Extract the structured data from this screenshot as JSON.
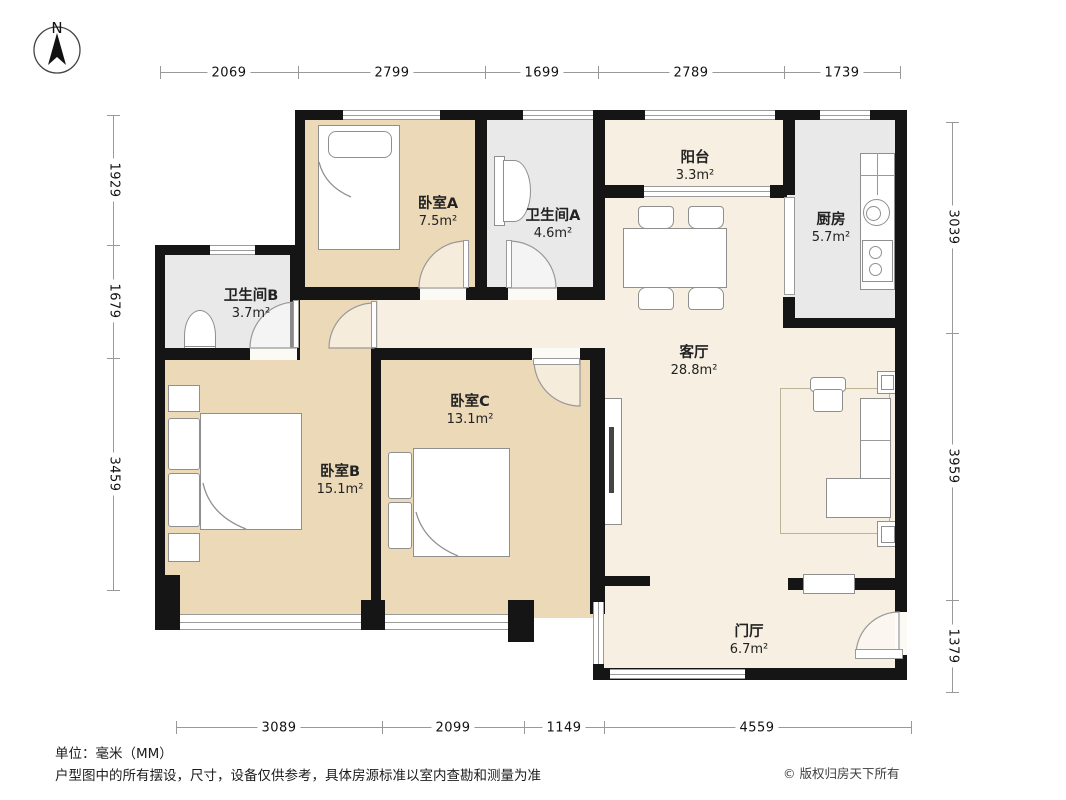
{
  "north": {
    "label": "N"
  },
  "dimensions": {
    "top": [
      "2069",
      "2799",
      "1699",
      "2789",
      "1739"
    ],
    "left": [
      "1929",
      "1679",
      "3459"
    ],
    "right": [
      "3039",
      "3959",
      "1379"
    ],
    "bottom": [
      "3089",
      "2099",
      "1149",
      "4559"
    ]
  },
  "rooms": {
    "bedroom_a": {
      "name": "卧室A",
      "area": "7.5m²"
    },
    "bathroom_a": {
      "name": "卫生间A",
      "area": "4.6m²"
    },
    "balcony": {
      "name": "阳台",
      "area": "3.3m²"
    },
    "kitchen": {
      "name": "厨房",
      "area": "5.7m²"
    },
    "bathroom_b": {
      "name": "卫生间B",
      "area": "3.7m²"
    },
    "bedroom_b": {
      "name": "卧室B",
      "area": "15.1m²"
    },
    "bedroom_c": {
      "name": "卧室C",
      "area": "13.1m²"
    },
    "living_room": {
      "name": "客厅",
      "area": "28.8m²"
    },
    "foyer": {
      "name": "门厅",
      "area": "6.7m²"
    }
  },
  "footer": {
    "unit_note": "单位：毫米（MM）",
    "disclaimer": "户型图中的所有摆设，尺寸，设备仅供参考，具体房源标准以室内查勘和测量为准",
    "copyright": "© 版权归房天下所有"
  },
  "colors": {
    "bedroom_floor": "#ecd9b8",
    "living_floor": "#f7efe1",
    "service_floor": "#e9e9e9",
    "wall": "#151515"
  }
}
